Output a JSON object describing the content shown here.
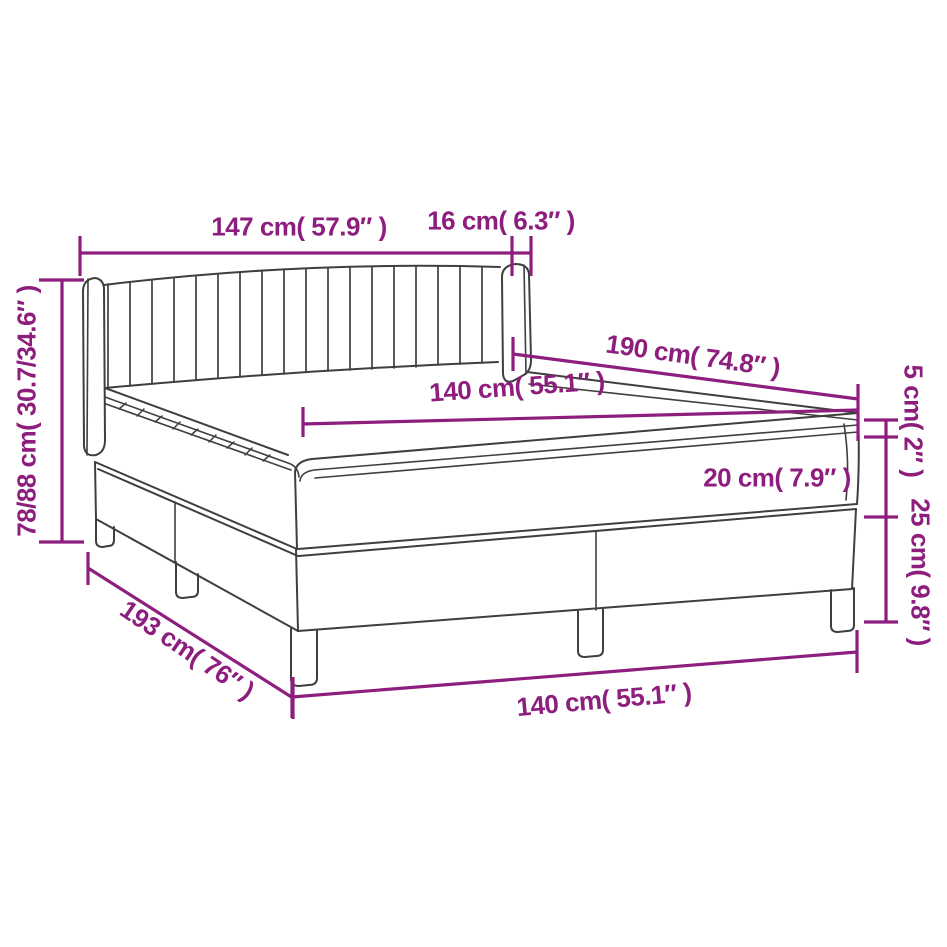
{
  "diagram": {
    "type": "product-dimension-diagram",
    "subject": "box-spring-bed-with-headboard",
    "colors": {
      "accent": "#8E1E7E",
      "drawing_line": "#3F3F3E",
      "background": "#FFFFFF"
    },
    "dimensions": {
      "headboard_width": "147 cm( 57.9″ )",
      "wing_depth": "16 cm( 6.3″ )",
      "total_height": "78/88 cm( 30.7/34.6″ )",
      "bed_length": "190 cm( 74.8″ )",
      "mattress_width_top": "140 cm( 55.1″ )",
      "topper_height": "5 cm( 2″ )",
      "mattress_height": "20 cm( 7.9″ )",
      "base_height": "25 cm( 9.8″ )",
      "frame_length": "193 cm( 76″ )",
      "mattress_width_bottom": "140 cm( 55.1″ )"
    }
  }
}
